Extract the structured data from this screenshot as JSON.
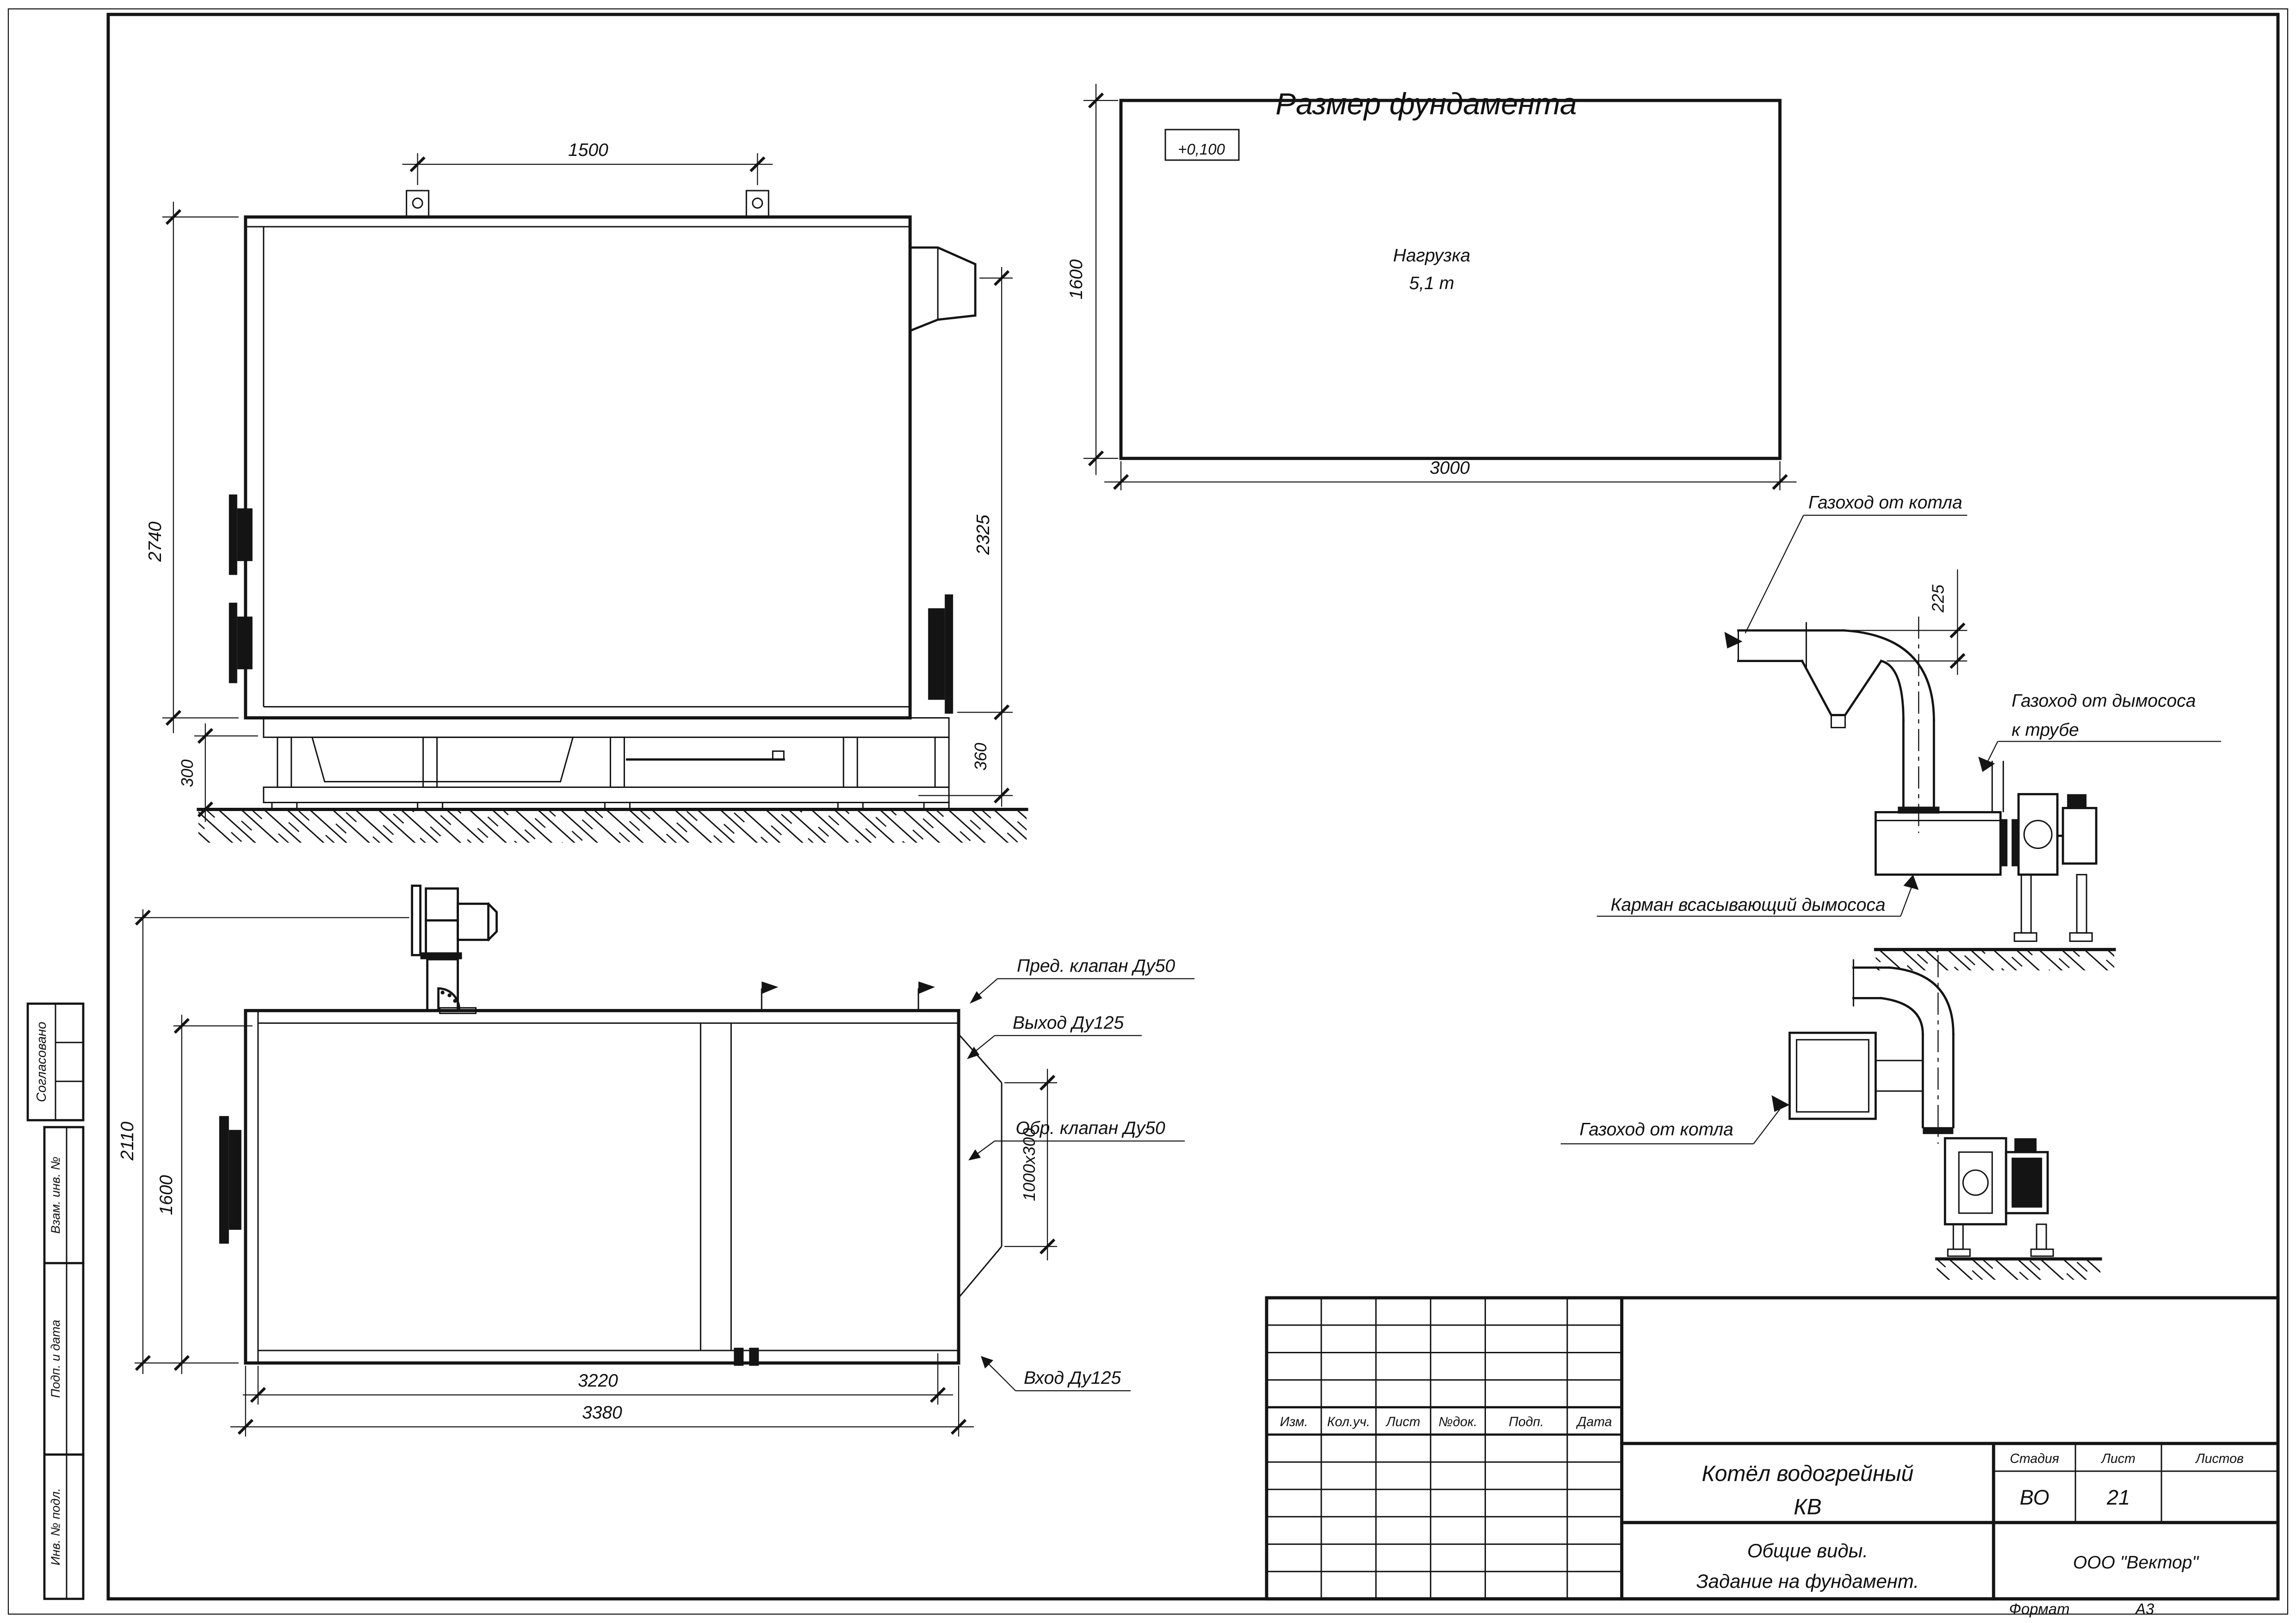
{
  "sheet": {
    "title": "Размер фундамента",
    "format_label": "Формат",
    "format_value": "А3"
  },
  "left_stamp": {
    "agreed": "Согласовано",
    "replace_inv": "Взам. инв. №",
    "sign_date": "Подп. и дата",
    "inv_orig": "Инв. № подл."
  },
  "foundation_plan": {
    "elevation": "+0,100",
    "load_line1": "Нагрузка",
    "load_line2": "5,1 т",
    "dim_depth": "1600",
    "dim_width": "3000"
  },
  "side_view": {
    "dim_lugs": "1500",
    "dim_height": "2740",
    "dim_outlet": "2325",
    "dim_base_left": "300",
    "dim_base_right": "360"
  },
  "plan_view": {
    "dim_height_outer": "2110",
    "dim_height_inner": "1600",
    "dim_width_inner": "3220",
    "dim_width_outer": "3380",
    "dim_outlet": "1000x300",
    "label_safety_valve": "Пред. клапан Ду50",
    "label_outlet": "Выход Ду125",
    "label_check_valve": "Обр. клапан Ду50",
    "label_inlet": "Вход Ду125"
  },
  "duct_upper": {
    "label_from_boiler": "Газоход от котла",
    "dim_offset": "225",
    "label_to_stack_1": "Газоход от дымососа",
    "label_to_stack_2": "к трубе",
    "label_pocket": "Карман всасывающий дымососа"
  },
  "duct_lower": {
    "label_from_boiler": "Газоход от котла"
  },
  "title_block": {
    "rev_headers": [
      "Изм.",
      "Кол.уч.",
      "Лист",
      "№док.",
      "Подп.",
      "Дата"
    ],
    "doc_name_1": "Котёл водогрейный",
    "doc_name_2": "КВ",
    "stage_label": "Стадия",
    "sheet_label": "Лист",
    "sheets_label": "Листов",
    "stage_value": "ВО",
    "sheet_value": "21",
    "sheets_value": "",
    "subtitle_1": "Общие виды.",
    "subtitle_2": "Задание на фундамент.",
    "company": "ООО \"Вектор\""
  }
}
